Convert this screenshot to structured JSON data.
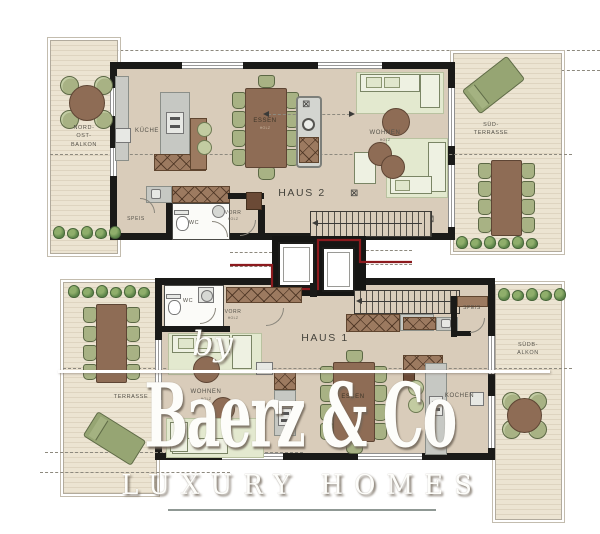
{
  "watermark": {
    "by": "by",
    "brand": "Baerz & Co",
    "tagline": "LUXURY HOMES"
  },
  "haus2": {
    "title": "HAUS 2",
    "balkon": {
      "lines": [
        "NORD-",
        "OST-",
        "BALKON"
      ]
    },
    "kueche": "KÜCHE",
    "essen": "ESSEN",
    "wohnen": "WOHNEN",
    "speis": "SPEIS",
    "wc": "WC",
    "vorr": "VORR",
    "terrasse": {
      "lines": [
        "SÜD-",
        "TERRASSE"
      ]
    },
    "material": "HOLZ"
  },
  "haus1": {
    "title": "HAUS 1",
    "wc": "WC",
    "vorr": "VORR",
    "speis": "SPEIS",
    "wohnen": "WOHNEN",
    "essen": "ESSEN",
    "kochen": "KOCHEN",
    "terrasse": "TERRASSE",
    "balkon": {
      "lines": [
        "SÜDB-",
        "ALKON"
      ]
    },
    "material": "HOLZ"
  },
  "symbols": {
    "ceiling_fixture": "⊠"
  },
  "colors": {
    "wall": "#1a1a18",
    "floor": "#d9ccba",
    "deck": "#ece4d2",
    "deck_stripe": "#ded4c0",
    "furniture_brown": "#8e6c55",
    "cabinet_brown": "#9c7a60",
    "chair_green": "#a8b284",
    "rug_green": "#e3e9cf",
    "counter_gray": "#c6c8c3",
    "plant_green": "#5d8549",
    "boundary_red": "#8c1a1e",
    "watermark_white": "#fdfdfa"
  }
}
